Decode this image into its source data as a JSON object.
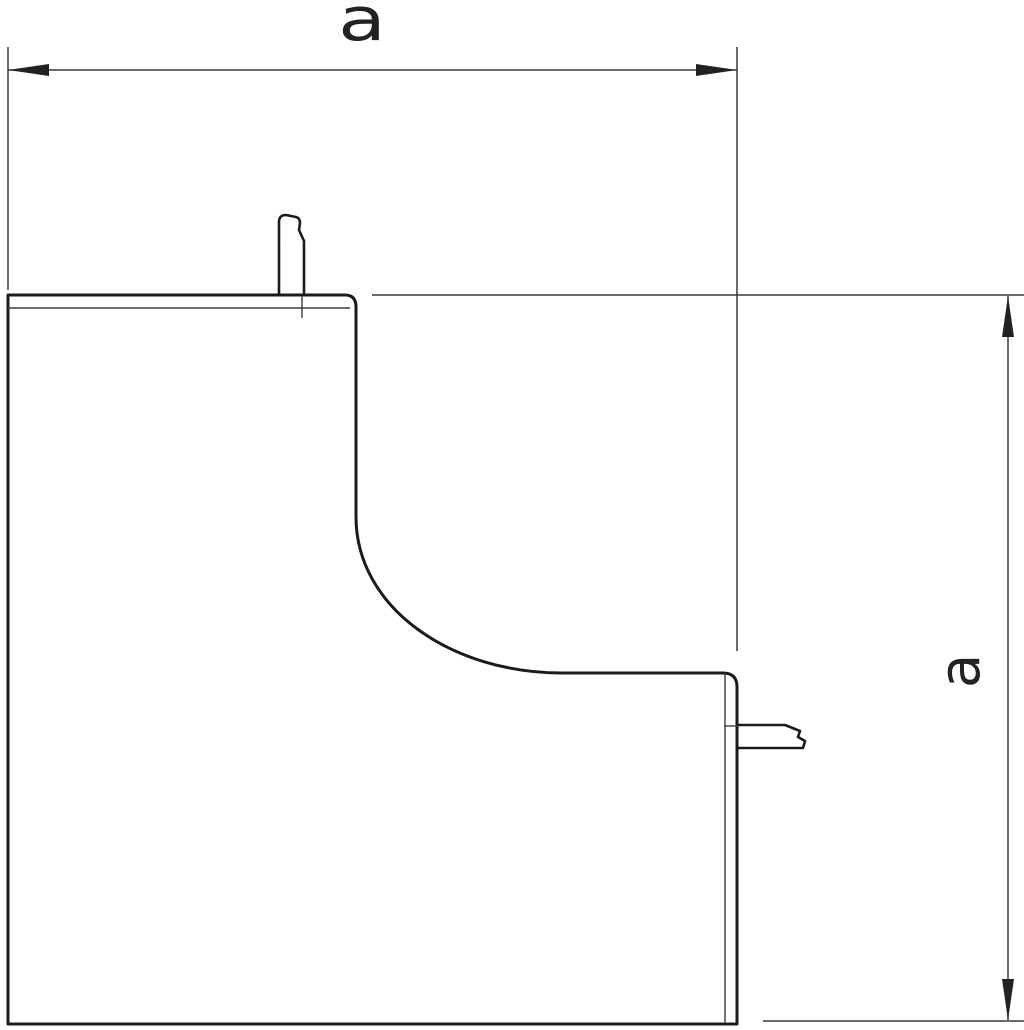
{
  "colors": {
    "background": "#ffffff",
    "outline": "#1b1b1b",
    "lip_line": "#3d3d3d",
    "dimension_line": "#3a3a3a",
    "arrow": "#222222",
    "label": "#222222"
  },
  "drawing": {
    "description": "Technical outline drawing of an internal corner trunking cover piece with two snap-in tabs and two equal dimension callouts",
    "horizontal_dimension": {
      "label": "a"
    },
    "vertical_dimension": {
      "label": "a"
    }
  }
}
